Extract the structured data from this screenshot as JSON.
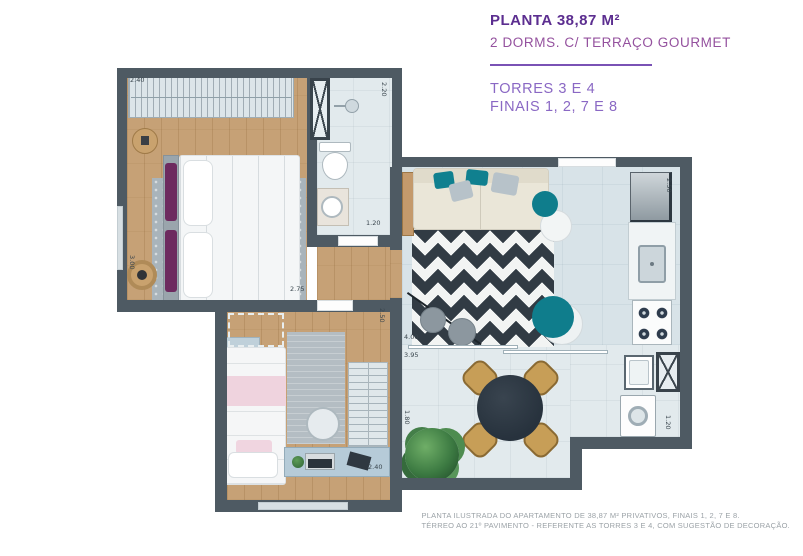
{
  "theme": {
    "title_color": "#5c2e90",
    "subtitle_color": "#94519e",
    "towers_color": "#8a68c4",
    "divider_color": "#7a52b5",
    "footer_color": "#9ba2a7",
    "wall_color": "#4e5a63",
    "wood_color": "#c6a176",
    "floor_color": "#e2eaed",
    "living_floor": "#d8e3e8",
    "accent_teal": "#0f7d8c",
    "dim_color": "#39454d"
  },
  "header": {
    "title": "PLANTA 38,87 M²",
    "subtitle": "2 DORMS. C/ TERRAÇO GOURMET",
    "towers_line1": "TORRES 3 E 4",
    "towers_line2": "FINAIS 1, 2, 7 E 8"
  },
  "footer": {
    "line1": "PLANTA ILUSTRADA DO APARTAMENTO DE 38,87 M² PRIVATIVOS, FINAIS 1, 2, 7 E 8.",
    "line2": "TÉRREO AO 21º PAVIMENTO - REFERENTE AS TORRES 3 E 4, COM SUGESTÃO DE DECORAÇÃO."
  },
  "floorplan": {
    "dims": [
      {
        "value": "2.40"
      },
      {
        "value": "3.00"
      },
      {
        "value": "2.20"
      },
      {
        "value": "1.20"
      },
      {
        "value": "2.75"
      },
      {
        "value": "2.50"
      },
      {
        "value": "2.50"
      },
      {
        "value": "4.00"
      },
      {
        "value": "3.95"
      },
      {
        "value": "1.80"
      },
      {
        "value": "2.40"
      },
      {
        "value": "1.20"
      }
    ]
  }
}
